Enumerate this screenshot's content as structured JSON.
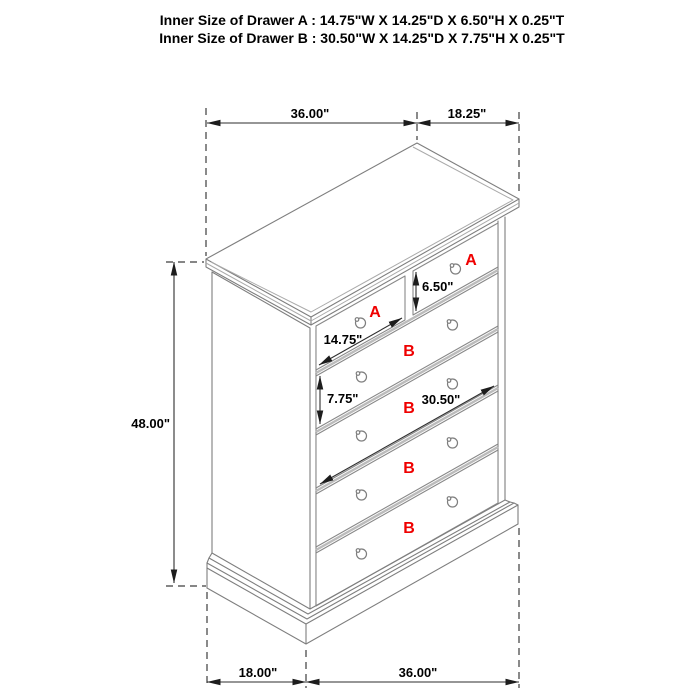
{
  "title": {
    "line1": "Inner Size of Drawer A : 14.75\"W X 14.25\"D X 6.50\"H X 0.25\"T",
    "line2": "Inner Size of Drawer B : 30.50\"W X 14.25\"D X 7.75\"H X 0.25\"T"
  },
  "dims": {
    "top_width": "36.00\"",
    "top_depth": "18.25\"",
    "height": "48.00\"",
    "bottom_depth": "18.00\"",
    "bottom_width": "36.00\"",
    "drawer_a_width": "14.75\"",
    "drawer_a_height": "6.50\"",
    "drawer_b_height": "7.75\"",
    "drawer_b_width": "30.50\""
  },
  "labels": {
    "drawer_a": "A",
    "drawer_b": "B"
  },
  "colors": {
    "label_red": "#ef0000",
    "line_gray": "#7e7e7e",
    "dim_dark": "#2e2e2e"
  }
}
